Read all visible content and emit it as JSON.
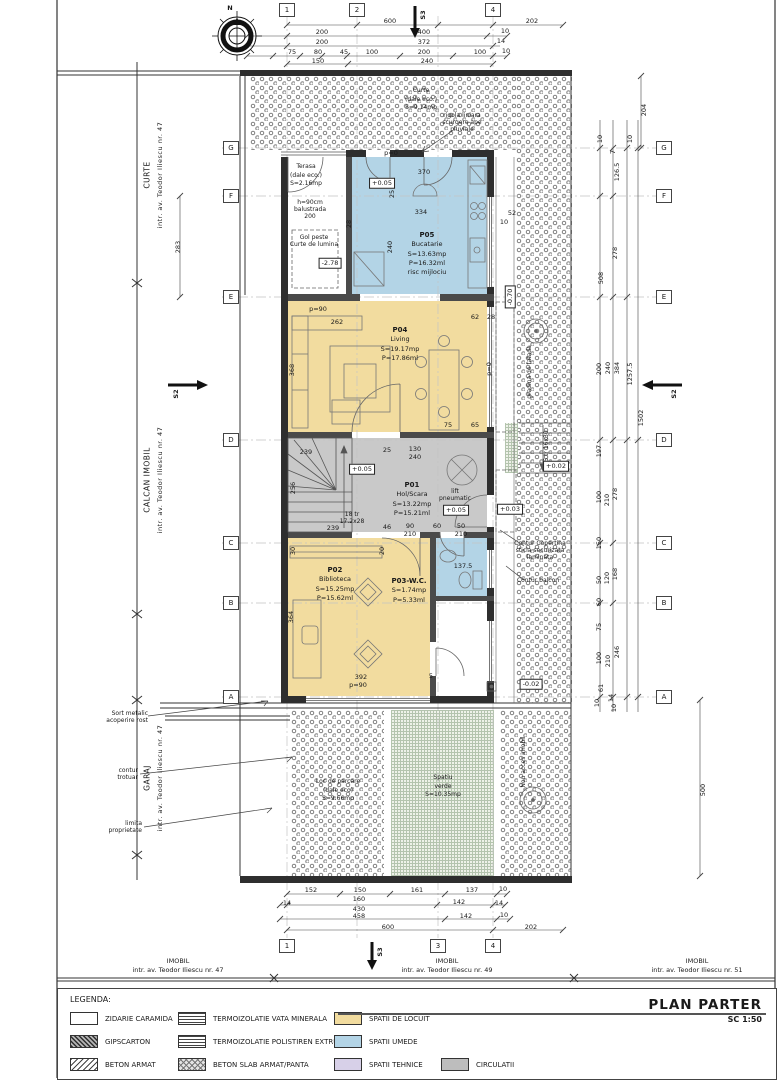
{
  "sheet": {
    "compass": "N",
    "title": "PLAN PARTER",
    "scale": "SC 1:50"
  },
  "colors": {
    "spatii_locuit": "#f2dc9f",
    "spatii_umede": "#b3d4e6",
    "spatii_tehnice": "#d7d0e8",
    "circulatii": "#c9c9c9"
  },
  "grid": {
    "cols_top": [
      "1",
      "2",
      "4"
    ],
    "cols_bottom": [
      "1",
      "3",
      "4"
    ],
    "rows": [
      "G",
      "F",
      "E",
      "D",
      "C",
      "B",
      "A"
    ],
    "s2": "S2",
    "s3": "S3"
  },
  "streets": {
    "left_top": {
      "name": "CURTE",
      "addr": "intr. av. Teodor Iliescu nr. 47"
    },
    "left_mid": {
      "name": "CALCAN IMOBIL",
      "addr": "intr. av. Teodor Iliescu nr. 47"
    },
    "left_bot": {
      "name": "GARAJ",
      "addr": "intr. av. Teodor Iliescu nr. 47"
    },
    "bot_left": {
      "name": "IMOBIL",
      "addr": "intr. av. Teodor Iliescu nr. 47"
    },
    "bot_mid": {
      "name": "IMOBIL",
      "addr": "intr. av. Teodor Iliescu nr. 49"
    },
    "bot_right": {
      "name": "IMOBIL",
      "addr": "intr. av. Teodor Iliescu nr. 51"
    }
  },
  "rooms": {
    "p05": {
      "id": "P05",
      "name": "Bucatarie",
      "area": "S=13.63mp",
      "perim": "P=16.32ml",
      "note": "risc mijlociu"
    },
    "p04": {
      "id": "P04",
      "name": "Living",
      "area": "S=19.17mp",
      "perim": "P=17.86ml"
    },
    "p01": {
      "id": "P01",
      "name": "Hol/Scara",
      "area": "S=13.22mp",
      "perim": "P=15.21ml"
    },
    "p02": {
      "id": "P02",
      "name": "Biblioteca",
      "area": "S=15.25mp",
      "perim": "P=15.62ml"
    },
    "p03": {
      "id": "P03-W.C.",
      "area": "S=1.74mp",
      "perim": "P=5.33ml"
    }
  },
  "outdoor": {
    "terasa": {
      "name": "Terasa",
      "sub": "(dale eco.)",
      "area": "S=2.16mp"
    },
    "curte": {
      "name": "Curte",
      "sub": "(dale eco.)",
      "area": "S=9.14mp"
    },
    "parcare": {
      "name": "Loc de parcare",
      "sub": "(dale eco)",
      "area": "S=9.66mp"
    },
    "verde": {
      "name": "Spatiu",
      "sub": "verde",
      "area": "S=10.35mp"
    },
    "acces": "Nou acces imobil",
    "gradina": "gradina de fatada"
  },
  "levels": {
    "lv1": "+0.05",
    "lv2": "+0.05",
    "lv3": "+0.05",
    "lv4": "+0.03",
    "lv5": "+0.02",
    "lv6": "-2.78",
    "lv7": "-0.02",
    "lv8": "-0.70"
  },
  "ann": {
    "balu1": "h=90cm",
    "balu2": "balustrada",
    "balu3": "200",
    "gol1": "Gol peste",
    "gol2": "Curte de lumina",
    "lift1": "lift",
    "lift2": "pneumatic",
    "st18a": "18 tr",
    "st18b": "17.2x28",
    "st5": "5 tr 16x30",
    "rig1": "rigola liniara",
    "rig2": "scurgere ape",
    "rig3": "pluviale",
    "cop1": "Contur Copertina",
    "cop2": "sticla securizata",
    "cop3": "laminata",
    "balc": "Contur balcon",
    "sort1": "Sort metalic",
    "sort2": "acoperire rost",
    "trot1": "contur",
    "trot2": "trotuar",
    "lim1": "limita",
    "lim2": "proprietate"
  },
  "dims": {
    "top1": [
      "600",
      "202"
    ],
    "top2": [
      "200",
      "400",
      "10"
    ],
    "top3": [
      "200",
      "372",
      "14"
    ],
    "top4": [
      "75",
      "80",
      "45",
      "100",
      "200",
      "100",
      "10"
    ],
    "top5": [
      "150",
      "240"
    ],
    "bot1": [
      "152",
      "150",
      "161",
      "137",
      "10"
    ],
    "bot2": [
      "14",
      "160",
      "430",
      "142",
      "14"
    ],
    "bot3": [
      "458",
      "142",
      "10"
    ],
    "bot4": [
      "600",
      "202"
    ],
    "left1": [
      "283"
    ],
    "right": [
      "204",
      "10",
      "7",
      "10",
      "126.5",
      "278",
      "508",
      "200",
      "240",
      "384",
      "1257.5",
      "1502",
      "197",
      "278",
      "100",
      "210",
      "150",
      "168",
      "120",
      "50",
      "60",
      "75",
      "246",
      "100",
      "210",
      "61",
      "14",
      "10",
      "10",
      "500"
    ],
    "kit": [
      "p=0",
      "370",
      "25",
      "334",
      "240",
      "52",
      "10",
      "28"
    ],
    "liv": [
      "p=90",
      "262",
      "368",
      "62",
      "28",
      "p=0",
      "75",
      "65"
    ],
    "hol": [
      "239",
      "25",
      "130",
      "240",
      "256",
      "239",
      "46",
      "90",
      "210",
      "60",
      "50",
      "210"
    ],
    "bib": [
      "30",
      "20",
      "392",
      "p=90",
      "364",
      "5",
      "137.5"
    ]
  },
  "legend": {
    "heading": "LEGENDA:",
    "materials": [
      {
        "label": "ZIDARIE CARAMIDA"
      },
      {
        "label": "GIPSCARTON"
      },
      {
        "label": "BETON ARMAT"
      },
      {
        "label": "TERMOIZOLATIE VATA MINERALA"
      },
      {
        "label": "TERMOIZOLATIE POLISTIREN EXTRUDAT"
      },
      {
        "label": "BETON SLAB ARMAT/PANTA"
      },
      {
        "label": "SPATII DE LOCUIT",
        "color": "#f2dc9f"
      },
      {
        "label": "SPATII UMEDE",
        "color": "#b3d4e6"
      },
      {
        "label": "SPATII TEHNICE",
        "color": "#d7d0e8"
      },
      {
        "label": "CIRCULATII",
        "color": "#bdbdbd"
      }
    ]
  }
}
